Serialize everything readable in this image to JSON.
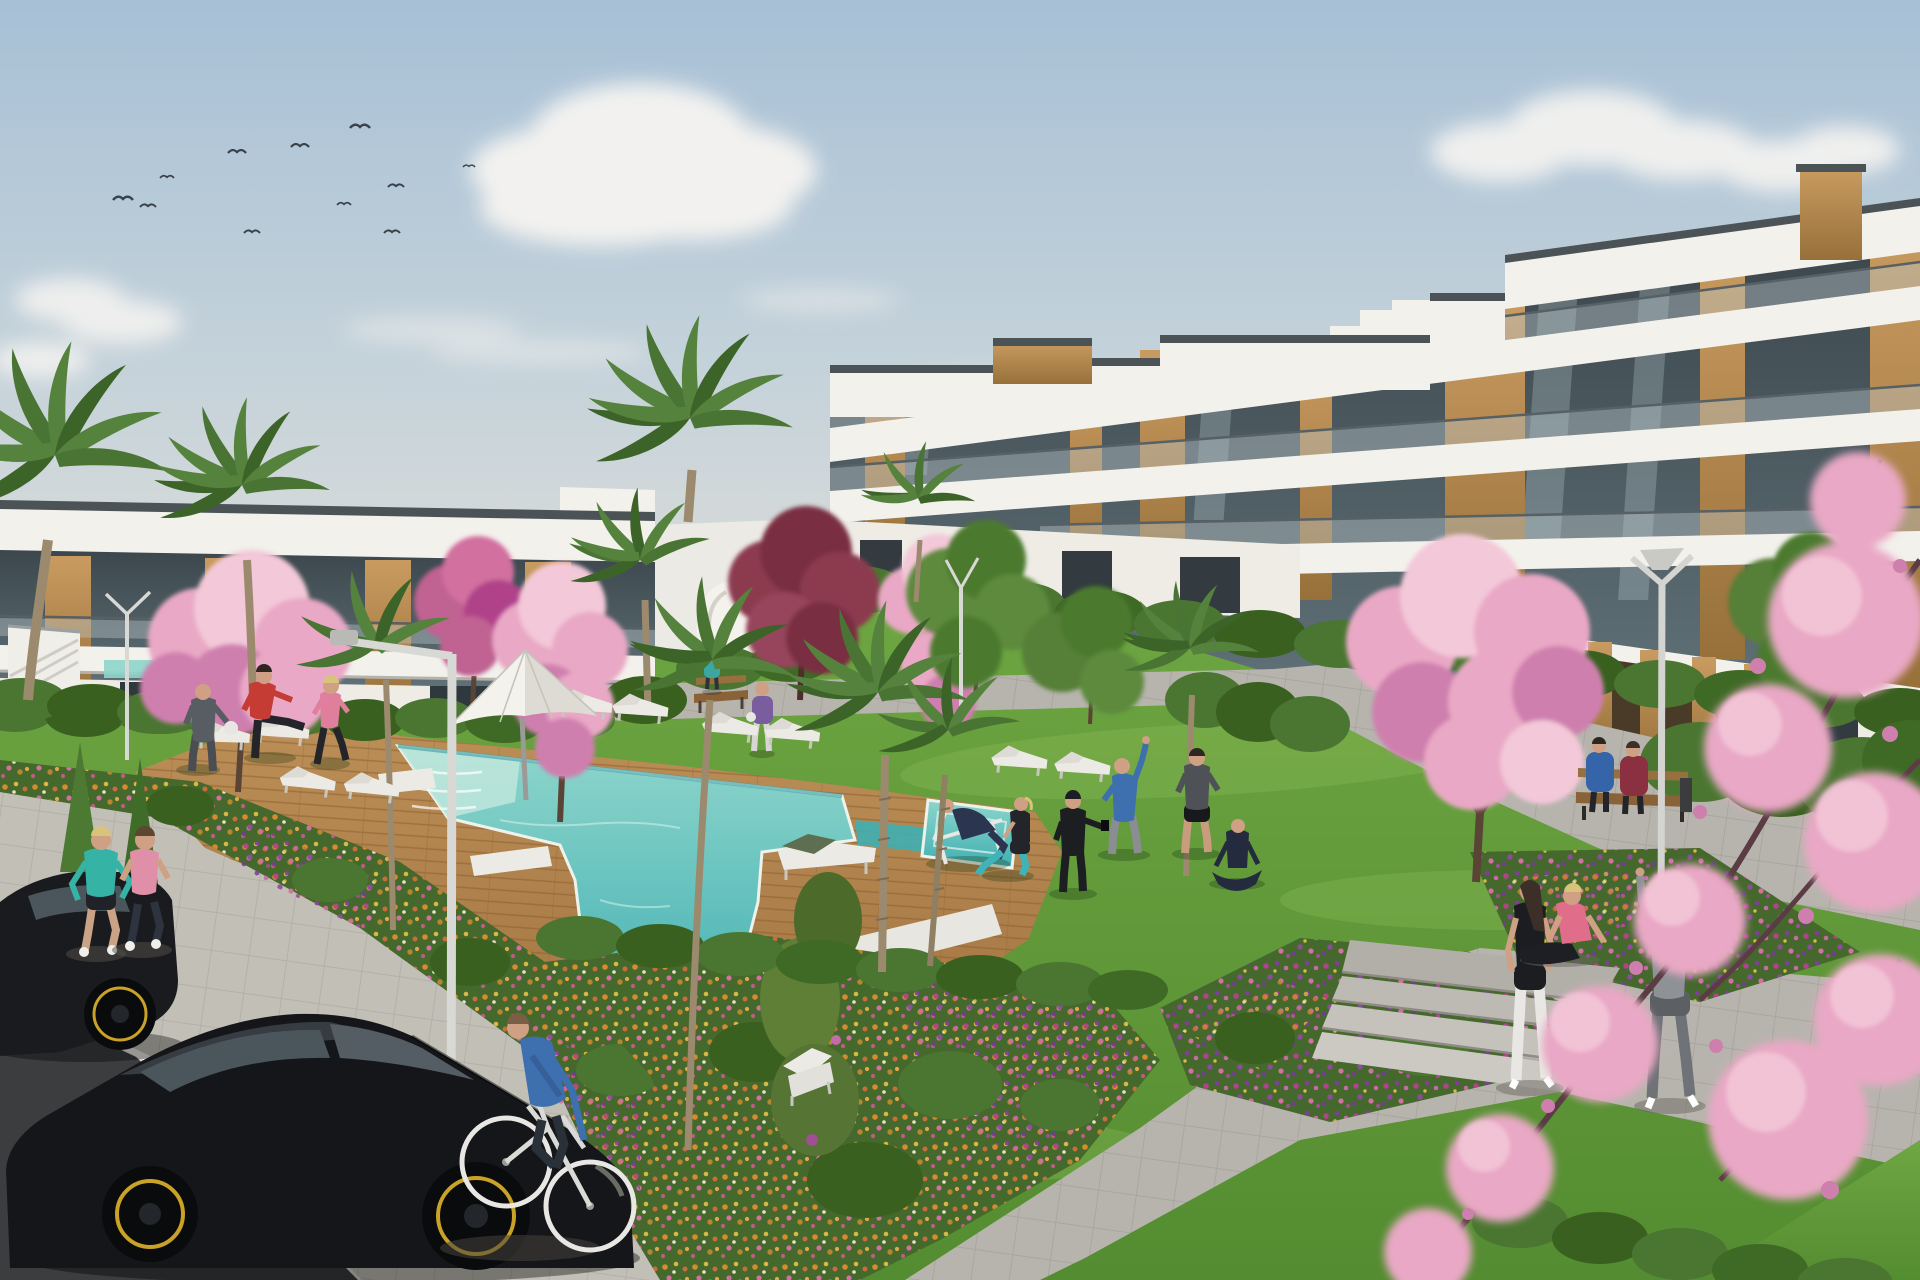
{
  "page": {
    "kind": "architectural-exterior-render",
    "description": "3D visualisation of a new-build white apartment complex with wood accents, communal garden, swimming pool, flower beds, parking with two black cars, and residents exercising",
    "width_px": 1920,
    "height_px": 1280
  },
  "palette": {
    "sky_top": "#a7c0d6",
    "sky_mid": "#c6d3da",
    "sky_horizon": "#e3e0d8",
    "cloud": "#f6f4f1",
    "building_white": "#f3f1ec",
    "building_shade": "#ddd9d2",
    "roof_dark": "#4c5357",
    "glass_dark": "#39444a",
    "glass_light": "#66787f",
    "balustrade": "#b9c6ca",
    "wood_light": "#c99b60",
    "wood_dark": "#97703a",
    "hedge": "#4a7631",
    "hedge_dark": "#39601f",
    "lawn": "#6fa743",
    "lawn_dark": "#548c31",
    "palm": "#55823c",
    "palm_dark": "#3c6428",
    "trunk": "#9b8a6d",
    "blossom": "#e9a8c5",
    "blossom_light": "#f3c8d8",
    "blossom_deep": "#cf7fae",
    "tree_red": "#8c3a50",
    "bed_green": "#45682c",
    "flower_orange": "#d88a2e",
    "flower_yellow": "#d9b843",
    "flower_pink": "#d2709f",
    "flower_magenta": "#b0438a",
    "flower_purple": "#7e3f97",
    "deck": "#bd9058",
    "deck_dark": "#a0713f",
    "deck_line": "#8a5f30",
    "pool_shallow": "#bfe6dc",
    "pool_light": "#8ed5cb",
    "pool_deep": "#3fafb2",
    "path": "#b7b4ad",
    "path_light": "#c2bfb7",
    "asphalt": "#3b3d3f",
    "marking": "#e8e7e3",
    "car_black": "#141619",
    "car_glass": "#535d63",
    "wheel_accent": "#c9a227",
    "skin": "#cfa084",
    "white": "#ffffff"
  },
  "scene": {
    "sky": {
      "birds_count": 11,
      "clouds": [
        "large cumulus centre-left",
        "puff row upper right",
        "small cloud left",
        "thin wisps near horizon"
      ]
    },
    "buildings": {
      "left_block": {
        "floors_visible": 2,
        "style": "white render, dark glazing, vertical wood panels, external stair at left"
      },
      "right_block": {
        "floors_visible": 3,
        "style": "white balcony slabs, glass balustrades, wood-clad piers, rooftop wooden volumes, stepped parapet"
      },
      "link": {
        "features": [
          "curved sculptural white wall",
          "wood door panel"
        ]
      }
    },
    "pool_area": {
      "pool": {
        "shape": "long pool with near lobe and separate jacuzzi",
        "water": "turquoise",
        "steps": "shallow entry at left end"
      },
      "deck": "timber with plank joints",
      "white_parasol": 1,
      "sun_loungers": 12,
      "deck_bridges": 2
    },
    "street_furniture": {
      "street_lamps": 4,
      "benches": 2,
      "concrete_steps": 3
    },
    "people": [
      {
        "id": "walker-grey",
        "location": "left deck",
        "clothing": "grey t-shirt, dark trousers",
        "activity": "walking with white towel"
      },
      {
        "id": "stretcher-red",
        "location": "left deck",
        "clothing": "red t-shirt, black leggings",
        "activity": "leg stretch on lounger"
      },
      {
        "id": "jogger-left",
        "location": "left lawn",
        "clothing": "pink top, black leggings",
        "activity": "jogging"
      },
      {
        "id": "jogger-teal",
        "location": "sidewalk",
        "clothing": "teal long-sleeve, black shorts",
        "activity": "jogging"
      },
      {
        "id": "jogger-pink",
        "location": "sidewalk",
        "clothing": "pink tank, dark capris",
        "activity": "jogging"
      },
      {
        "id": "cyclist",
        "location": "sidewalk",
        "clothing": "blue sweater, dark jeans",
        "activity": "riding a white bicycle"
      },
      {
        "id": "child-teal",
        "location": "courtyard",
        "clothing": "teal top",
        "activity": "standing"
      },
      {
        "id": "walker-purple",
        "location": "courtyard",
        "clothing": "purple top, white trousers",
        "activity": "strolling"
      },
      {
        "id": "man-deckchair",
        "location": "pool lawn",
        "clothing": "navy outfit",
        "activity": "reclining in deck chair"
      },
      {
        "id": "woman-squat",
        "location": "pool lawn",
        "clothing": "black top, turquoise leggings",
        "activity": "squat exercise"
      },
      {
        "id": "person-tracksuit",
        "location": "pool lawn",
        "clothing": "black tracksuit",
        "activity": "standing"
      },
      {
        "id": "man-stretch-blue",
        "location": "pool lawn",
        "clothing": "blue t-shirt, grey joggers",
        "activity": "side stretch, arm raised"
      },
      {
        "id": "man-grey-shorts",
        "location": "pool lawn",
        "clothing": "grey top, black shorts",
        "activity": "stretching"
      },
      {
        "id": "person-crossleg",
        "location": "pool lawn",
        "clothing": "navy tracksuit",
        "activity": "seated cross-legged"
      },
      {
        "id": "woman-standing-black",
        "location": "right steps",
        "clothing": "black tank, white leggings",
        "activity": "standing"
      },
      {
        "id": "woman-sitting-pink",
        "location": "right steps",
        "clothing": "pink tank, black leggings",
        "activity": "seated stretch"
      },
      {
        "id": "person-arms-up",
        "location": "right path",
        "clothing": "grey hoodie and joggers",
        "activity": "overhead stretch"
      },
      {
        "id": "bench-pair",
        "location": "bench on right path",
        "clothing": "blue jacket; dark red top",
        "activity": "sitting"
      }
    ],
    "vehicles": [
      {
        "id": "car-rear",
        "type": "hatchback",
        "color": "black",
        "state": "parked, partially out of frame"
      },
      {
        "id": "car-front",
        "type": "hatchback",
        "color": "black",
        "detail": "yellow wheel accents",
        "state": "parked"
      },
      {
        "id": "bicycle",
        "color": "white",
        "state": "in use"
      }
    ],
    "vegetation": {
      "palms": 10,
      "blossom_trees": 5,
      "dark_red_tree": 1,
      "green_trees": 3,
      "flower_beds": [
        {
          "id": "left-bed",
          "colors": [
            "orange",
            "yellow",
            "pink",
            "magenta"
          ]
        },
        {
          "id": "centre-bed",
          "colors": [
            "orange",
            "magenta",
            "purple"
          ]
        },
        {
          "id": "right-bed",
          "colors": [
            "purple",
            "magenta",
            "orange"
          ]
        },
        {
          "id": "upper-right-bed",
          "colors": [
            "purple",
            "magenta"
          ]
        }
      ],
      "hedges": "clipped green hedges along facades and paths"
    }
  }
}
